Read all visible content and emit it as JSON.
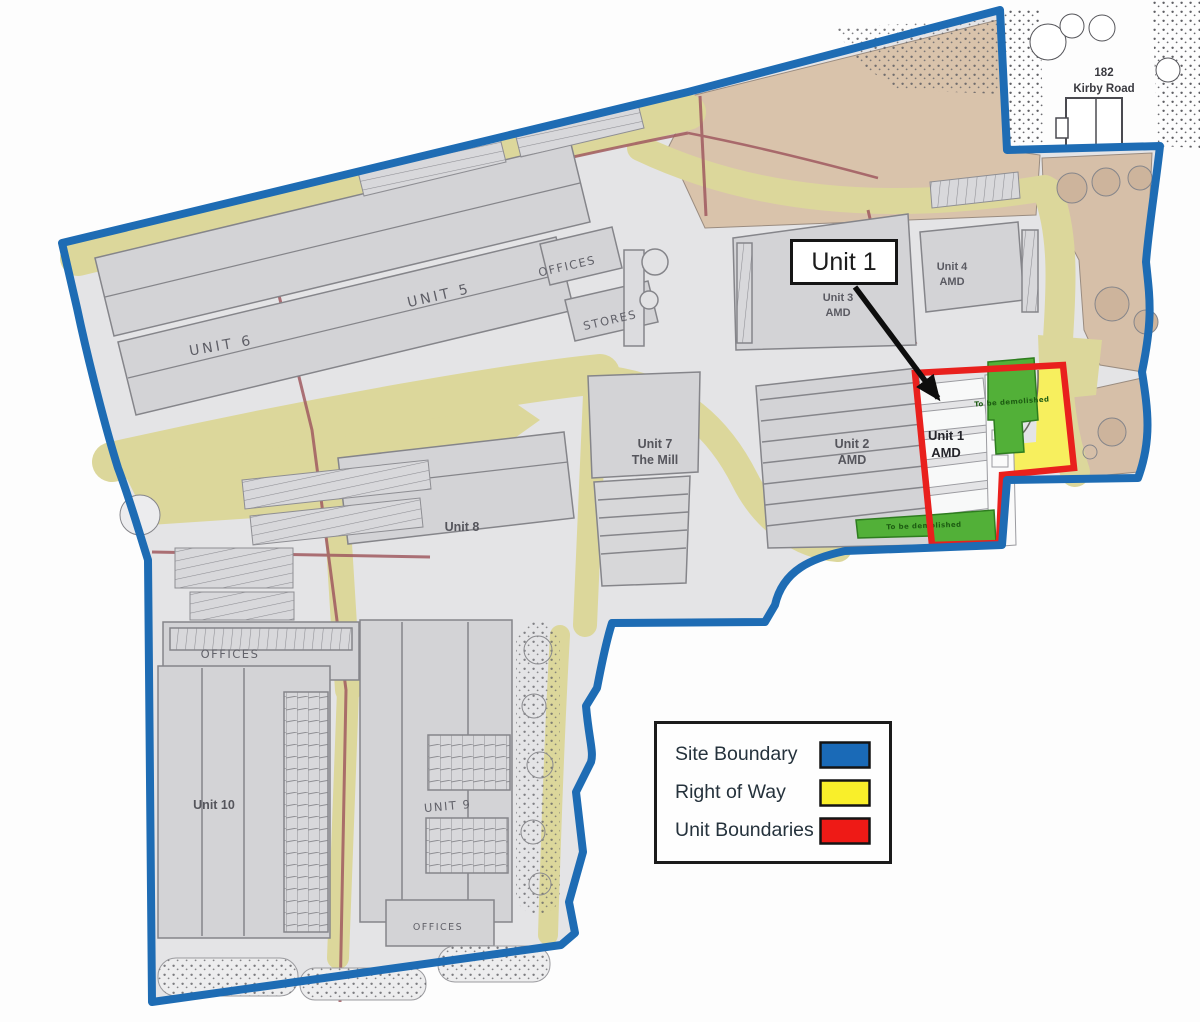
{
  "callout": {
    "label": "Unit 1"
  },
  "legend": {
    "items": [
      {
        "label": "Site Boundary",
        "color": "#1a6ab7"
      },
      {
        "label": "Right of Way",
        "color": "#f9ef2a"
      },
      {
        "label": "Unit Boundaries",
        "color": "#ee1a16"
      }
    ]
  },
  "labels": {
    "unit6": "UNIT 6",
    "unit5": "UNIT 5",
    "offices_top": "OFFICES",
    "stores": "STORES",
    "unit3_l1": "Unit 3",
    "unit3_l2": "AMD",
    "unit4_l1": "Unit 4",
    "unit4_l2": "AMD",
    "unit2_l1": "Unit 2",
    "unit2_l2": "AMD",
    "unit1_l1": "Unit 1",
    "unit1_l2": "AMD",
    "unit7_l1": "Unit 7",
    "unit7_l2": "The Mill",
    "unit8": "Unit 8",
    "offices_mid": "OFFICES",
    "unit10": "Unit 10",
    "unit9": "UNIT 9",
    "offices_bottom": "OFFICES",
    "kirby_l1": "182",
    "kirby_l2": "Kirby Road",
    "green_note": "To be demolished"
  },
  "map_colors": {
    "site_boundary": "#1a6ab7",
    "right_of_way_road": "#dcd79b",
    "right_of_way_highlight": "#f7ef5e",
    "unit_boundary": "#ee1a16",
    "landscaping_green": "#52b038"
  }
}
